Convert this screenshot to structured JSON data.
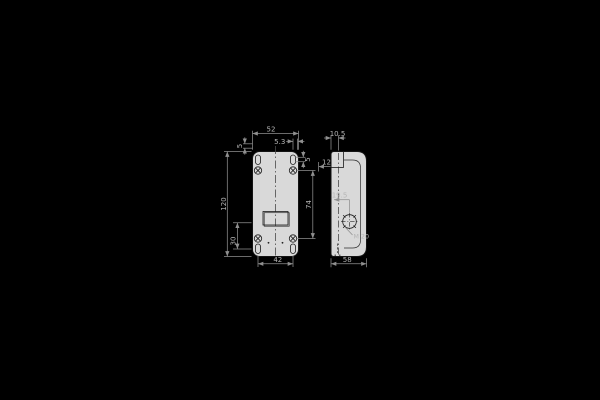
{
  "canvas": {
    "kind": "technical-drawing",
    "background_color": "#000000"
  },
  "palette": {
    "dimension_color": "#8f8f8f",
    "dimension_text_color": "#b5b5b5",
    "part_fill": "#d9d9d9",
    "part_outline": "#141414"
  },
  "front_view": {
    "label": "front view of enclosure",
    "dim_width_top": "52",
    "dim_hole_edge_offset": "5.3",
    "dim_slot_offset_top_left": "5",
    "dim_slot_offset_top_right": "5",
    "dim_height_overall": "120",
    "dim_hole_spacing_vertical": "74",
    "dim_lower_left": "30",
    "dim_hole_spacing_bottom": "42",
    "dim_cover_step": "12"
  },
  "side_view": {
    "label": "side view of enclosure",
    "dim_cover_depth": "10.5",
    "dim_knockout_center": "19.5",
    "knockout_label": "M 20",
    "dim_depth_overall": "58"
  }
}
